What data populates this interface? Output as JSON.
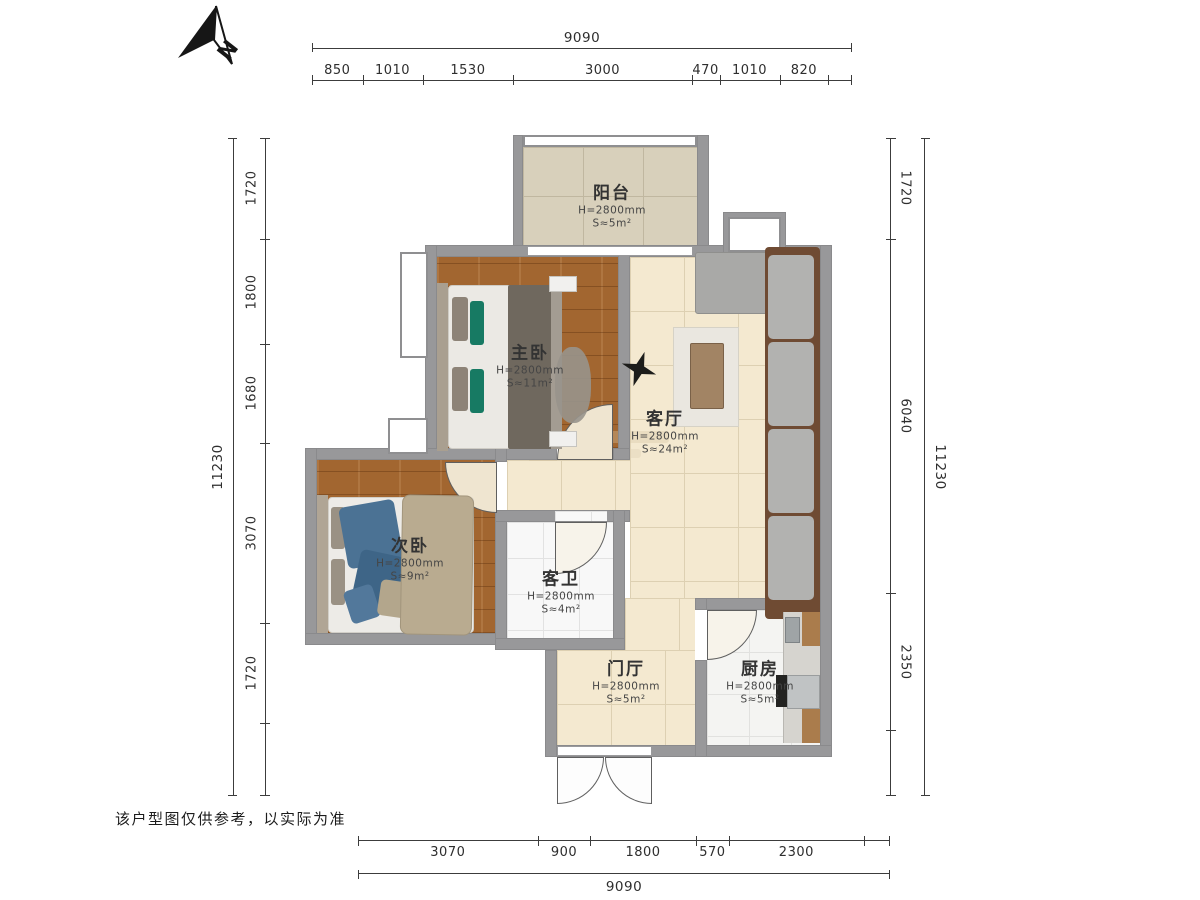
{
  "north": {
    "label": "N"
  },
  "disclaimer": "该户型图仅供参考，以实际为准",
  "dimensions": {
    "top": {
      "total": "9090",
      "segments": [
        "850",
        "1010",
        "1530",
        "3000",
        "470",
        "1010",
        "820"
      ]
    },
    "bottom": {
      "total": "9090",
      "segments": [
        "3070",
        "900",
        "1800",
        "570",
        "2300"
      ]
    },
    "left": {
      "total": "11230",
      "segments": [
        "1720",
        "1800",
        "1680",
        "3070",
        "1720"
      ]
    },
    "right": {
      "total": "11230",
      "segments": [
        "1720",
        "6040",
        "2350"
      ]
    }
  },
  "rooms": {
    "balcony": {
      "name": "阳台",
      "height": "H=2800mm",
      "area": "S≈5m²"
    },
    "master_bedroom": {
      "name": "主卧",
      "height": "H=2800mm",
      "area": "S≈11m²"
    },
    "living_room": {
      "name": "客厅",
      "height": "H=2800mm",
      "area": "S≈24m²"
    },
    "second_bedroom": {
      "name": "次卧",
      "height": "H=2800mm",
      "area": "S≈9m²"
    },
    "guest_bathroom": {
      "name": "客卫",
      "height": "H=2800mm",
      "area": "S≈4m²"
    },
    "entrance_hall": {
      "name": "门厅",
      "height": "H=2800mm",
      "area": "S≈5m²"
    },
    "kitchen": {
      "name": "厨房",
      "height": "H=2800mm",
      "area": "S≈5m²"
    }
  },
  "colors": {
    "wall": "#98989a",
    "wood_floor": "#a26630",
    "tile_cream": "#f4e9d0",
    "balcony_tile": "#d8d0bb",
    "marble": "#f8f8f8",
    "accent_teal": "#177a63",
    "sofa_brown": "#6f4b33",
    "dim_line": "#3c3c3c"
  }
}
